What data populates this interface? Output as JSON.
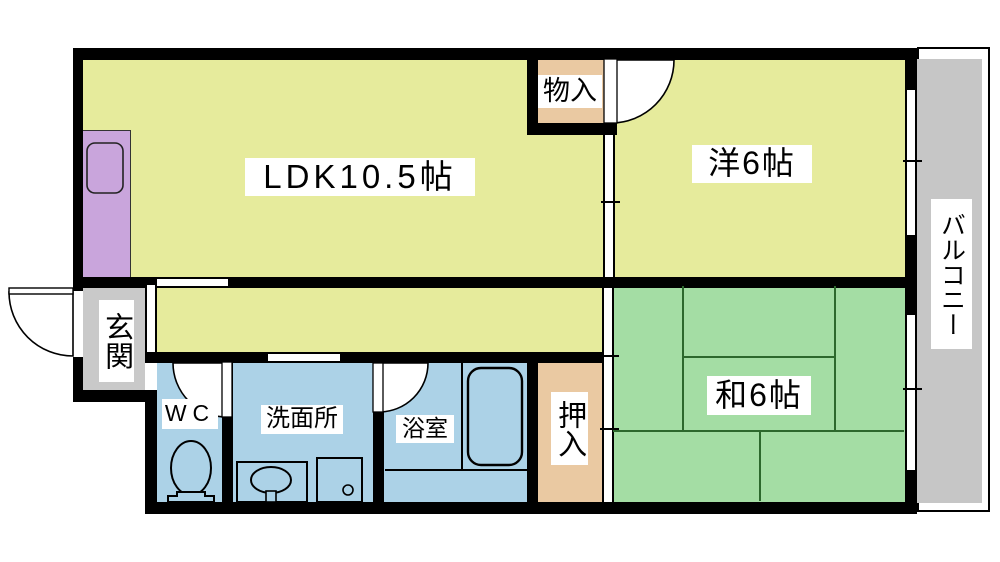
{
  "plan": {
    "type": "apartment-floor-plan",
    "rooms": {
      "ldk": {
        "label": "LDK10.5帖",
        "color": "#e6eb9c"
      },
      "western_room": {
        "label": "洋6帖",
        "color": "#e6eb9c"
      },
      "japanese_room": {
        "label": "和6帖",
        "color": "#a4dda4",
        "tatami_line_color": "#2d682d"
      },
      "storage": {
        "label": "物入",
        "color": "#eac9a2"
      },
      "entrance": {
        "label": "玄関",
        "color": "#c9c9c9"
      },
      "wc": {
        "label": "WC",
        "color": "#acd2e7"
      },
      "washroom": {
        "label": "洗面所",
        "color": "#acd2e7"
      },
      "bathroom": {
        "label": "浴室",
        "color": "#acd2e7"
      },
      "closet": {
        "label": "押入",
        "color": "#eac9a2"
      },
      "corridor": {
        "label": "",
        "color": "#e6eb9c"
      },
      "balcony": {
        "label": "バルコニー",
        "color": "#c6c6c6"
      }
    },
    "kitchen_color": "#c9a5dc",
    "wall_color": "#000000",
    "fixtures": [
      "kitchen-sink",
      "toilet",
      "washbasin-counter",
      "washing-machine-pan",
      "bathtub"
    ],
    "doors": [
      "entrance-swing-door",
      "wc-swing-door",
      "bathroom-swing-door",
      "western-room-swing-door",
      "ldk-sliding-partition",
      "japanese-room-sliding-door",
      "entrance-hall-divider"
    ],
    "windows": [
      "western-room-window",
      "japanese-room-window"
    ]
  }
}
